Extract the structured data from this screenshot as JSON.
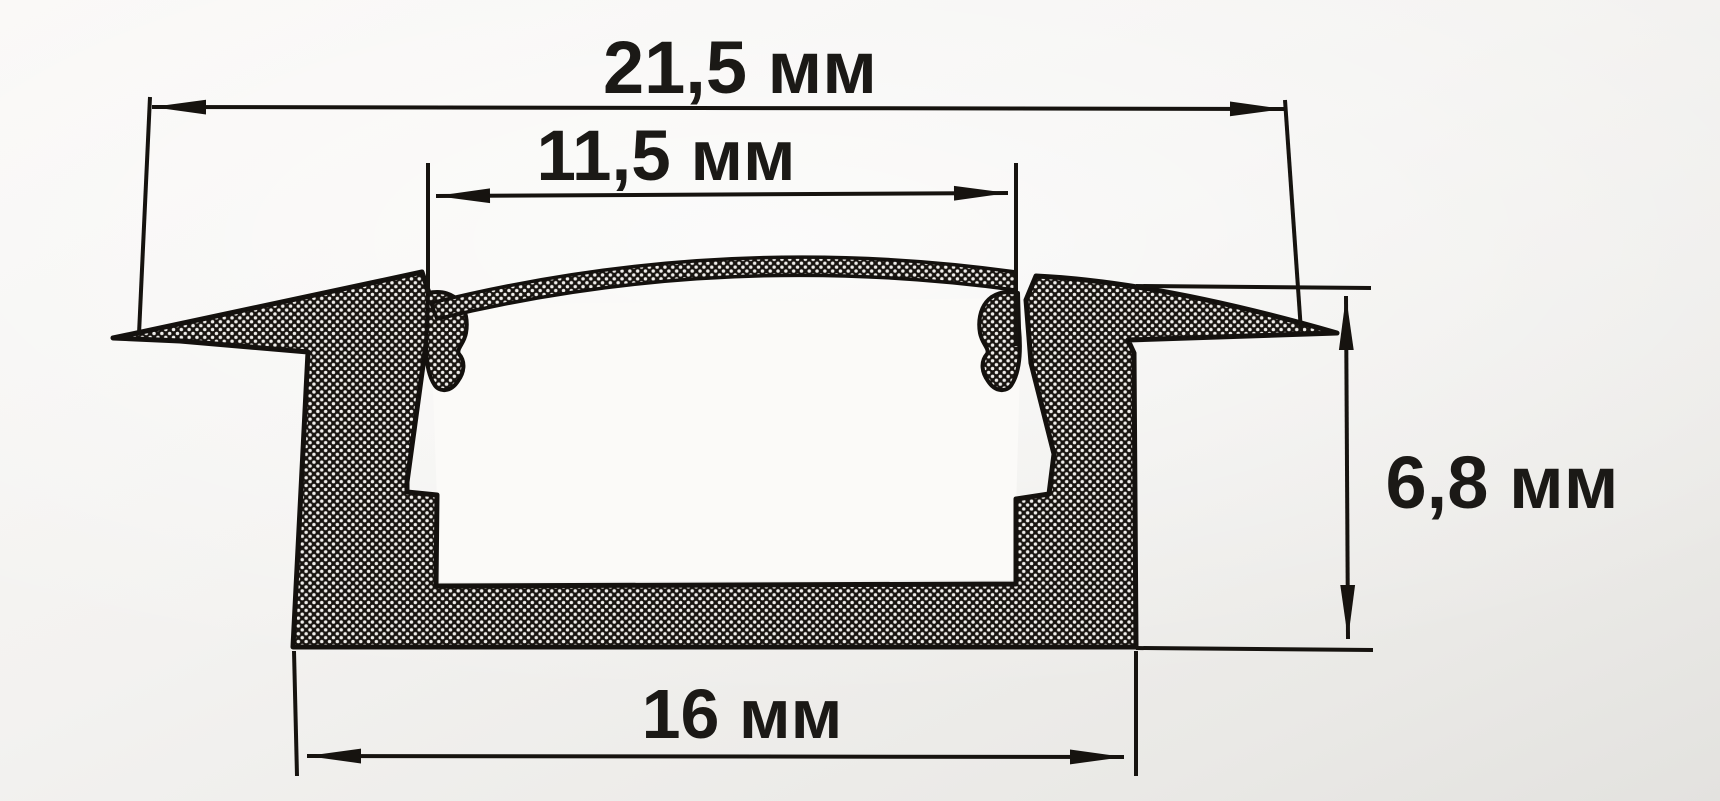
{
  "drawing": {
    "type": "cross-section dimension drawing",
    "subject": "recessed aluminium LED profile with diffuser cover",
    "units": "мм",
    "dimensions": {
      "overall_width": {
        "value": 21.5,
        "label": "21,5 мм"
      },
      "opening_width": {
        "value": 11.5,
        "label": "11,5 мм"
      },
      "height": {
        "value": 6.8,
        "label": "6,8 мм"
      },
      "base_width": {
        "value": 16,
        "label": "16 мм"
      }
    },
    "colors": {
      "ink": "#16130f",
      "paper": "#f2f1ef",
      "interior": "#fbfaf8"
    }
  }
}
